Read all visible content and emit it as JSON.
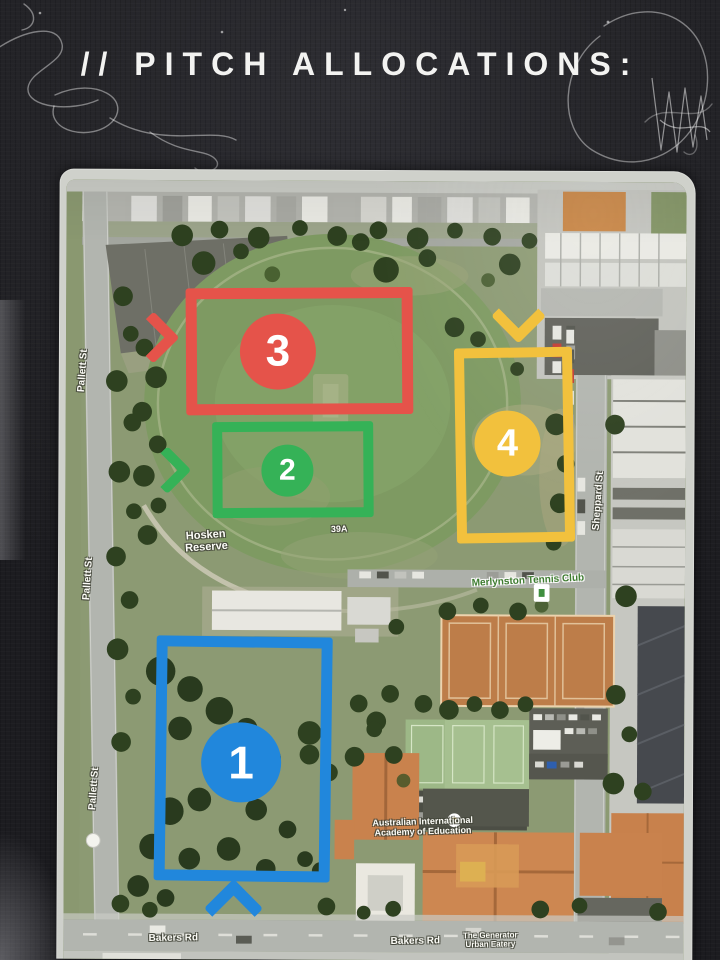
{
  "title": "// PITCH ALLOCATIONS:",
  "map": {
    "park_name_line1": "Hosken",
    "park_name_line2": "Reserve",
    "parcel_label": "39A",
    "streets": {
      "pallett_1": "Pallett St",
      "pallett_2": "Pallett St",
      "pallett_3": "Pallett St",
      "sheppard": "Sheppard St",
      "bakers_1": "Bakers Rd",
      "bakers_2": "Bakers Rd"
    },
    "pois": {
      "tennis_club": "Merlynston Tennis Club",
      "academy_line1": "Australian International",
      "academy_line2": "Academy of Education",
      "eatery_line1": "The Generator",
      "eatery_line2": "Urban Eatery"
    },
    "pitches": {
      "p1": {
        "number": "1",
        "color": "#2187dc",
        "arrow_direction": "up"
      },
      "p2": {
        "number": "2",
        "color": "#35b257",
        "arrow_direction": "right"
      },
      "p3": {
        "number": "3",
        "color": "#e5534a",
        "arrow_direction": "right"
      },
      "p4": {
        "number": "4",
        "color": "#f2c13d",
        "arrow_direction": "down"
      }
    }
  }
}
